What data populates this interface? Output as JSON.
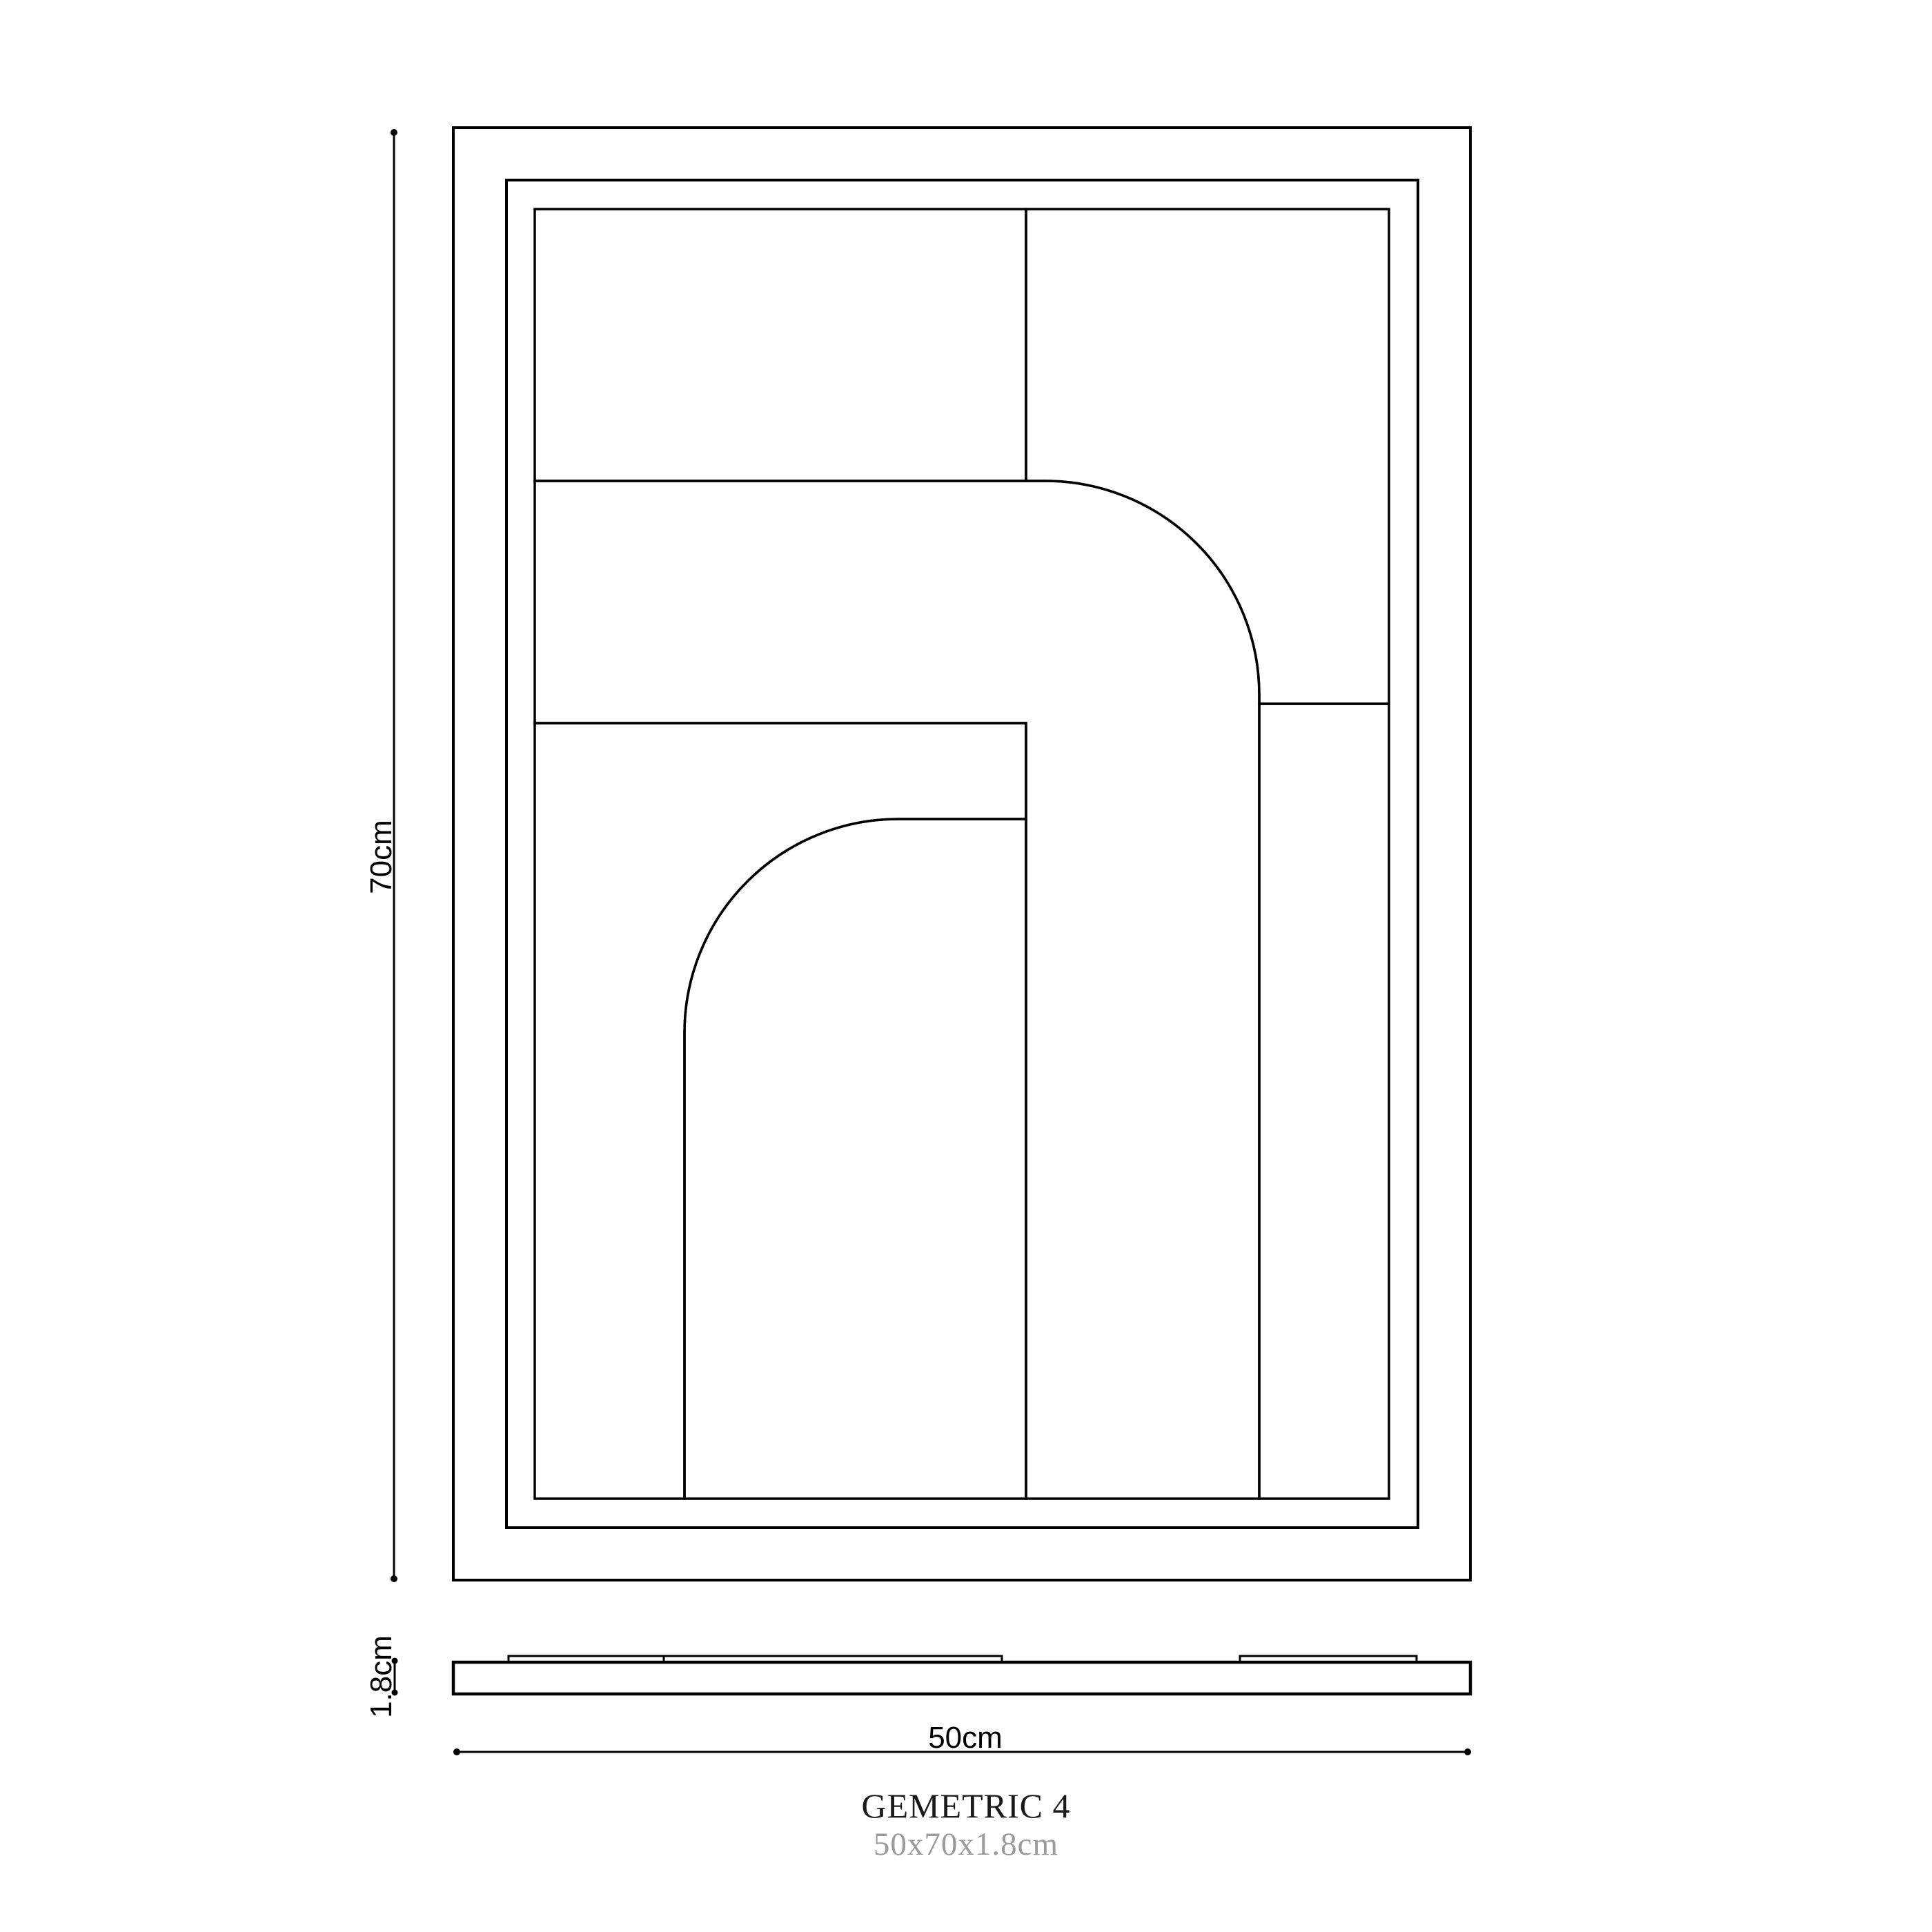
{
  "page": {
    "background": "#ffffff",
    "line_color": "#000000"
  },
  "footer": {
    "title": "GEMETRIC 4",
    "subtitle": "50x70x1.8cm",
    "title_color": "#1a1a1a",
    "subtitle_color": "#9a9a9a"
  },
  "dimensions": {
    "height": {
      "label": "70cm",
      "value_cm": 70
    },
    "width": {
      "label": "50cm",
      "value_cm": 50
    },
    "depth": {
      "label": "1.8cm",
      "value_cm": 1.8
    }
  }
}
